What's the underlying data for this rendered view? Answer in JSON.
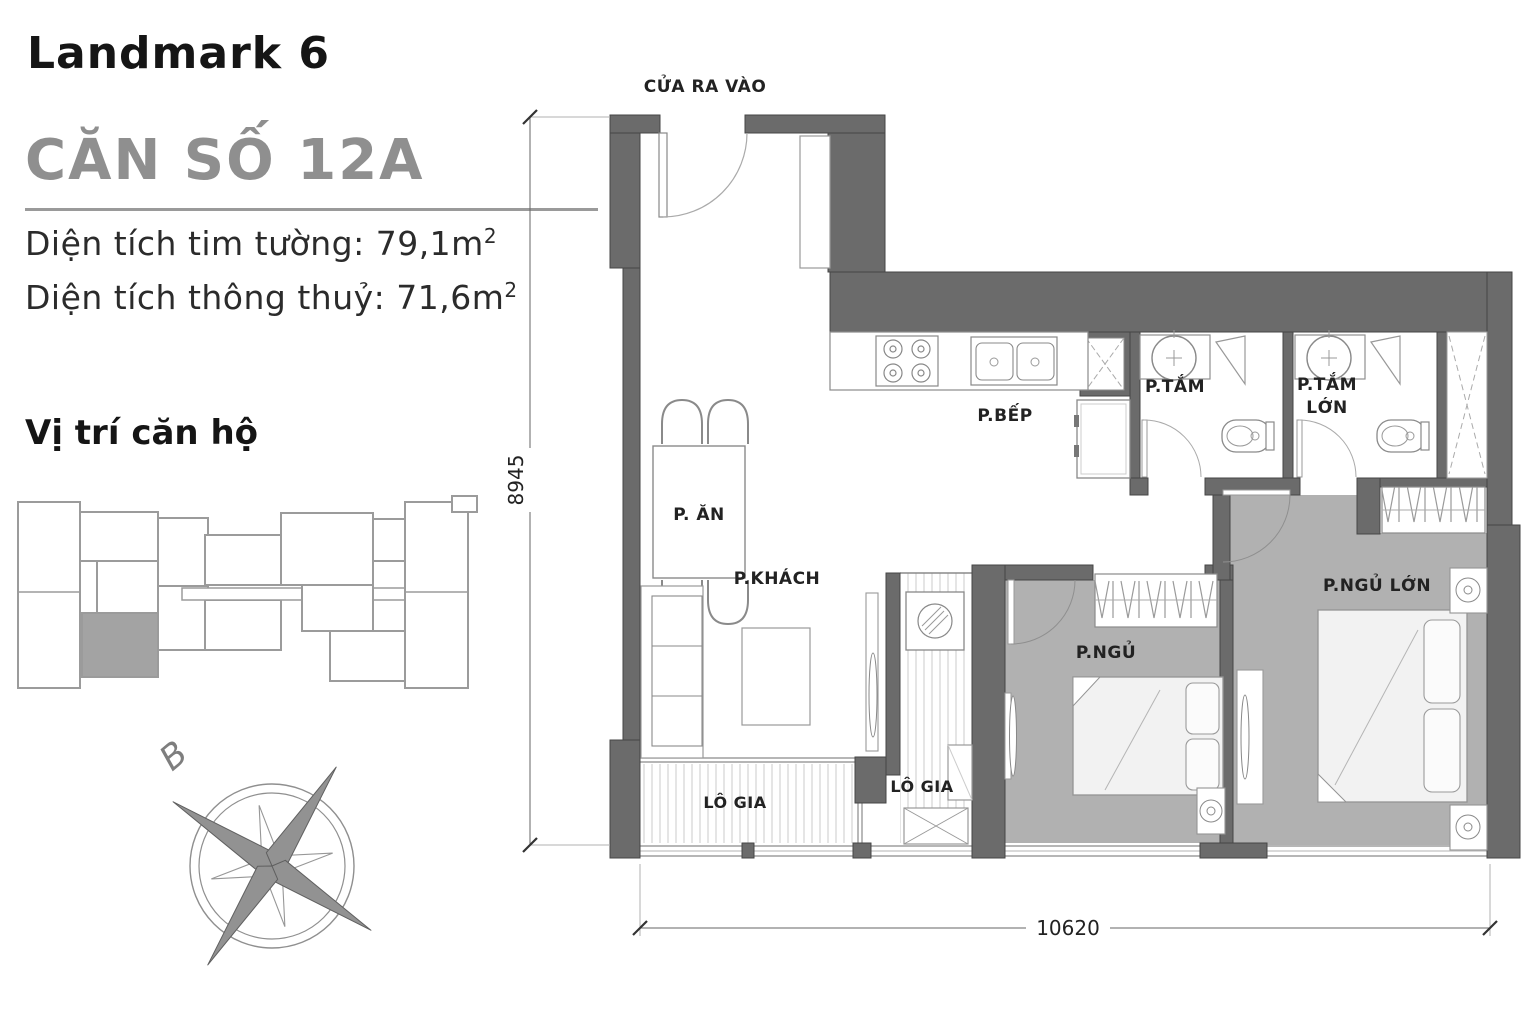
{
  "header": {
    "project_title": "Landmark 6",
    "unit_title": "CĂN SỐ 12A",
    "area_lines": [
      {
        "label_value": "Diện tích tim tường: 79,1m",
        "sup": "2"
      },
      {
        "label_value": "Diện tích thông thuỷ: 71,6m",
        "sup": "2"
      }
    ],
    "locator_title": "Vị trí căn hộ"
  },
  "compass": {
    "north_label": "B"
  },
  "plan": {
    "entrance_label": "CỬA RA VÀO",
    "rooms": {
      "dining": "P. ĂN",
      "living": "P.KHÁCH",
      "kitchen": "P.BẾP",
      "bathroom": "P.TẮM",
      "bathroom_large_line1": "P.TẮM",
      "bathroom_large_line2": "LỚN",
      "bedroom": "P.NGỦ",
      "bedroom_large": "P.NGỦ LỚN",
      "loggia_1": "LÔ GIA",
      "loggia_2": "LÔ GIA"
    },
    "dimensions": {
      "vertical": "8945",
      "horizontal": "10620"
    },
    "colors": {
      "wall": "#6b6b6b",
      "bedroom_floor": "#b1b1b1",
      "locator_highlight": "#a3a3a3"
    }
  }
}
